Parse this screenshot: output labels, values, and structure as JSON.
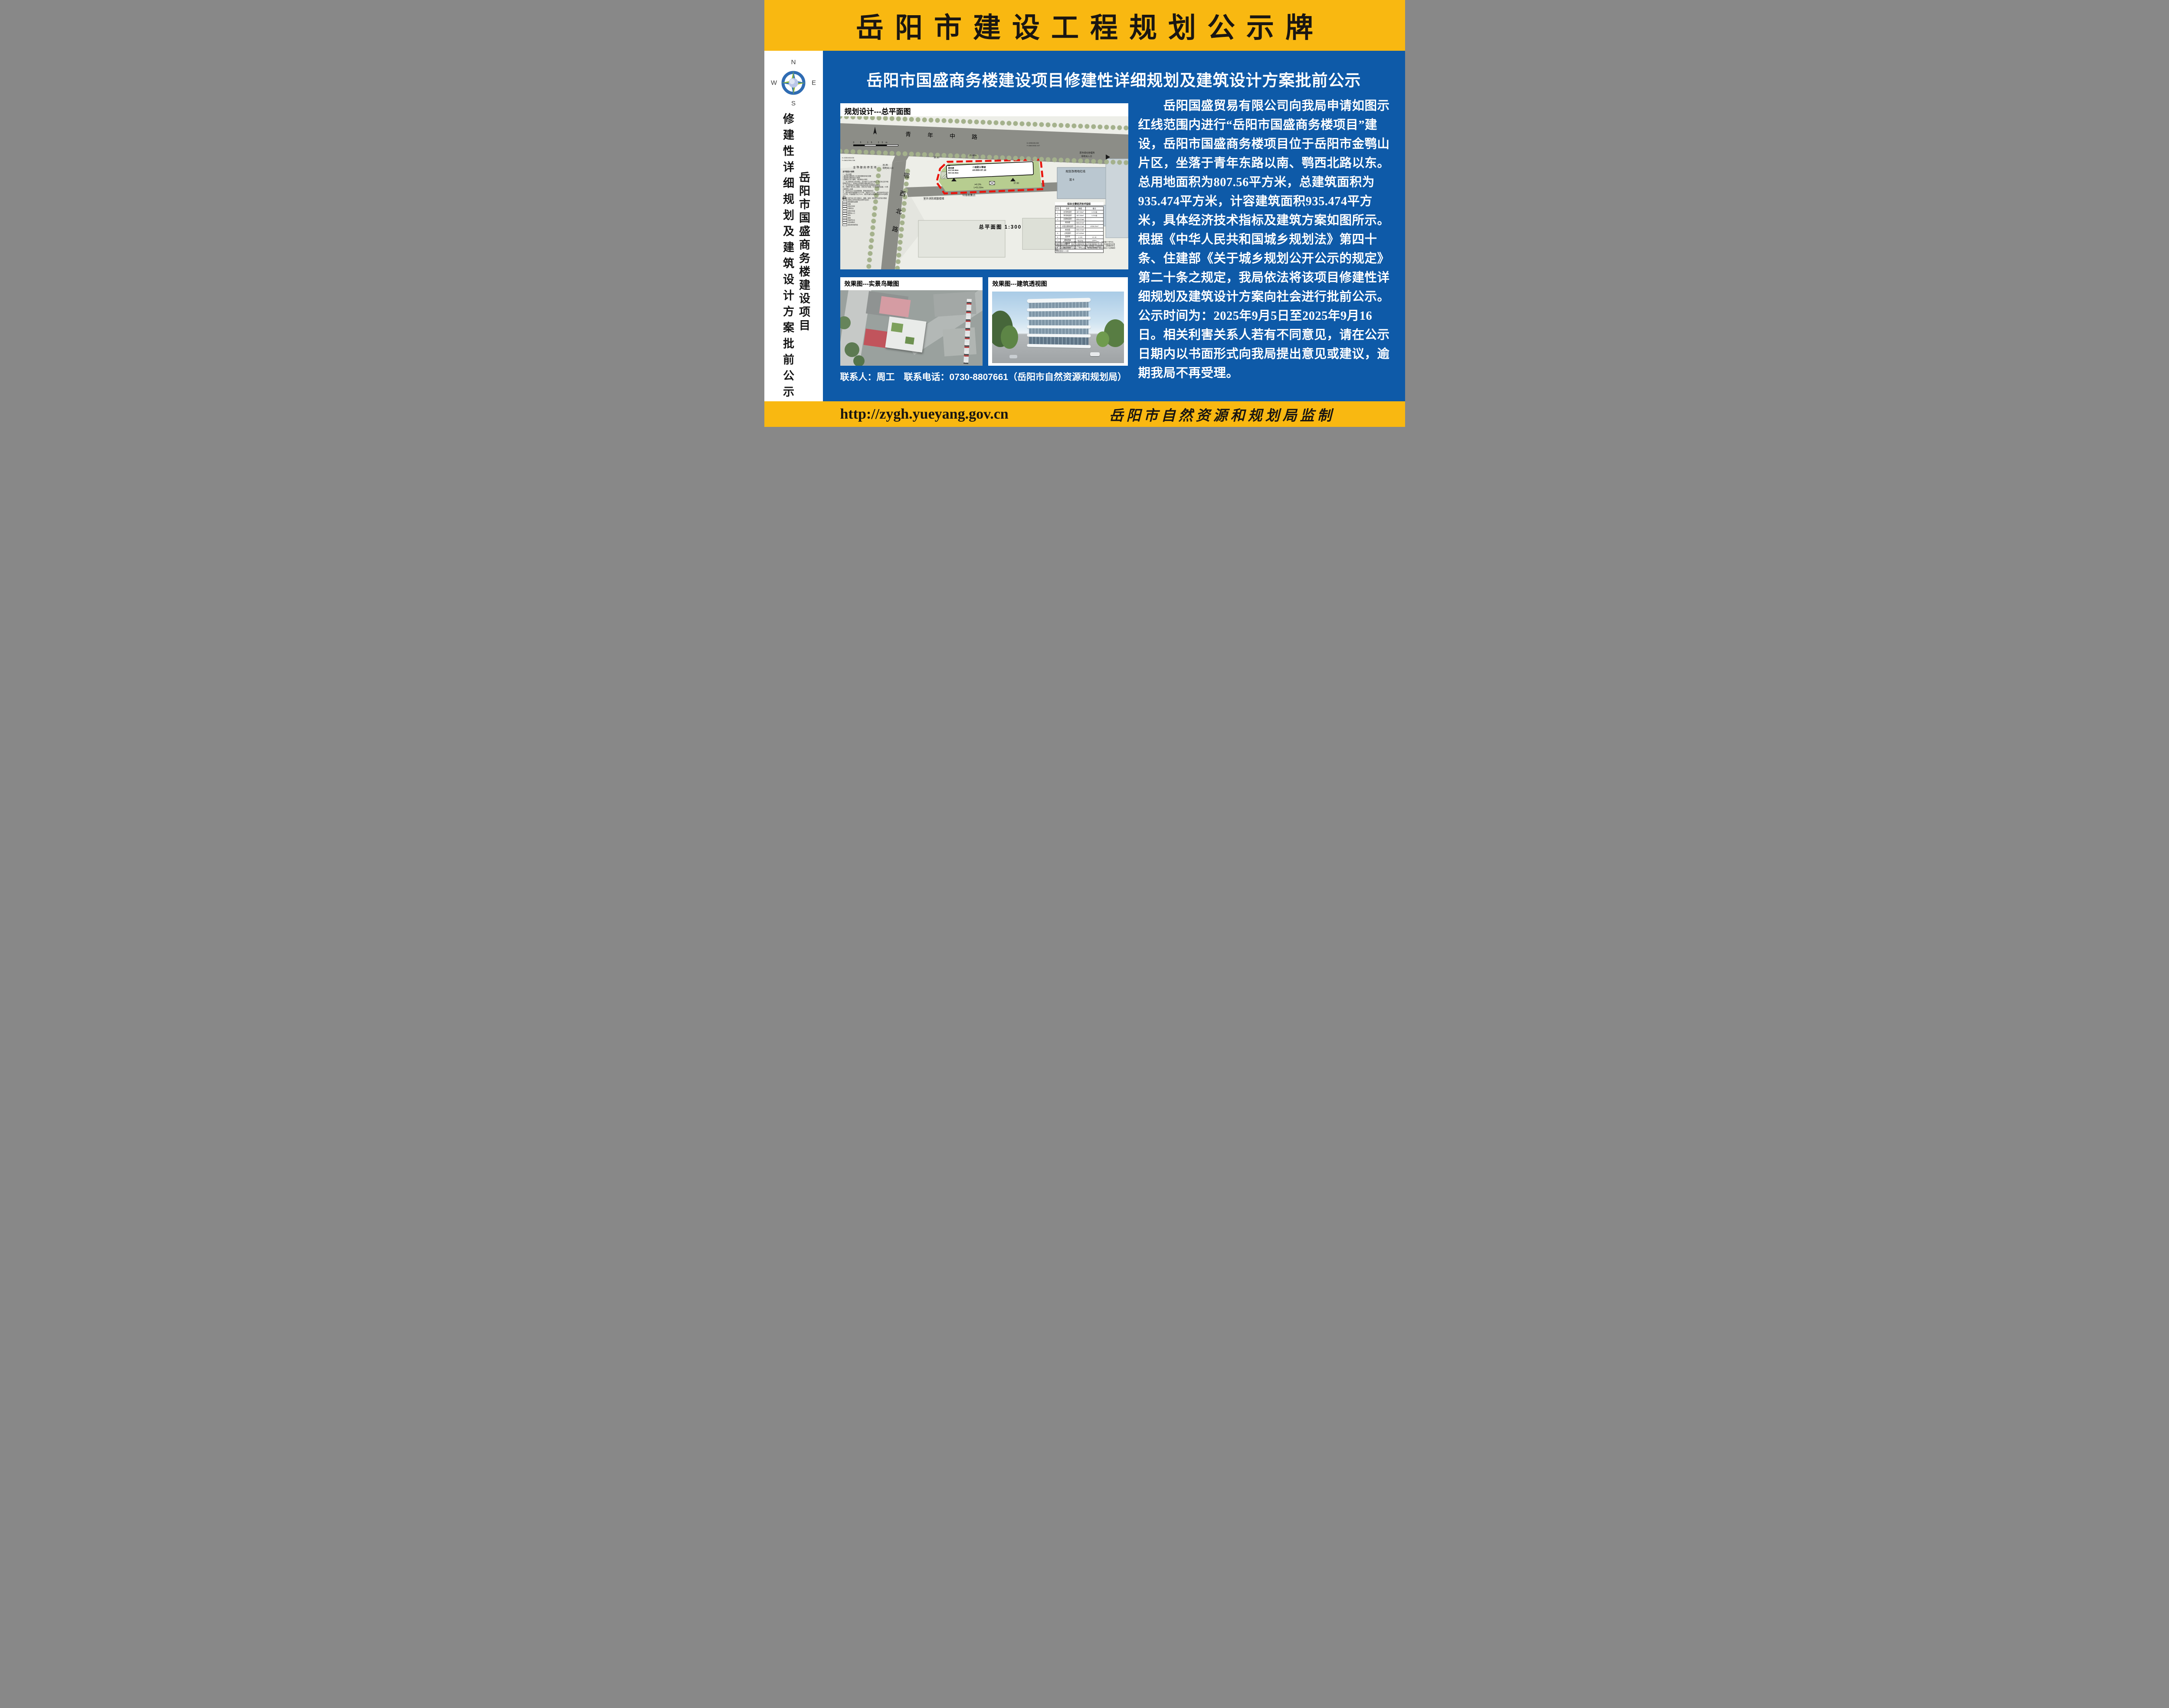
{
  "colors": {
    "yellow": "#F9B811",
    "blue": "#0E5AA8",
    "red": "#E8150C"
  },
  "header": {
    "title": "岳阳市建设工程规划公示牌"
  },
  "sidebar": {
    "compass": {
      "n": "N",
      "s": "S",
      "e": "E",
      "w": "W"
    },
    "vertical_outer": "修建性详细规划及建筑设计方案批前公示",
    "vertical_inner": "岳阳市国盛商务楼建设项目"
  },
  "main": {
    "title": "岳阳市国盛商务楼建设项目修建性详细规划及建筑设计方案批前公示",
    "contact": "联系人：周工　联系电话：0730-8807661（岳阳市自然资源和规划局）",
    "paragraph_lines": [
      "　　岳阳国盛贸易有限公司向我局申请如图示",
      "红线范围内进行“岳阳市国盛商务楼项目”建",
      "设，岳阳市国盛商务楼项目位于岳阳市金鹗山",
      "片区，坐落于青年东路以南、鹗西北路以东。",
      "总用地面积为807.56平方米，总建筑面积为",
      "935.474平方米，计容建筑面积935.474平方",
      "米，具体经济技术指标及建筑方案如图所示。",
      "根据《中华人民共和国城乡规划法》第四十",
      "条、住建部《关于城乡规划公开公示的规定》",
      "第二十条之规定，我局依法将该项目修建性详",
      "细规划及建筑设计方案向社会进行批前公示。",
      "公示时间为：2025年9月5日至2025年9月16",
      "日。相关利害关系人若有不同意见，请在公示",
      "日期内以书面形式向我局提出意见或建议，逾",
      "期我局不再受理。"
    ]
  },
  "site_plan": {
    "label": "规划设计---总平面图",
    "caption": "总平面图 1:300",
    "scale_text": "0 5 15 25m",
    "road_top": "青年中路",
    "road_left": "鄂西北路",
    "building": {
      "lines": [
        "4F",
        "商务楼",
        "H1=16.55m",
        "H2=15.05m"
      ],
      "fire": "二级耐火等级",
      "elev": "±0.000=37.10"
    },
    "labels": {
      "parking_lot": "金鹗御府停车场",
      "entrance_owner": "原市绿化管理所",
      "entrance": "场地出入口",
      "entrance_elev": "36.85",
      "redline": "规划净用地红线",
      "mix6": "混 6",
      "internal_road_1": "接原市绿化管理所",
      "internal_road_2": "内部道路",
      "trash": "垃圾收集点",
      "fire_stairs": "室外消防疏散楼梯",
      "slope": "i=0.3%",
      "road_len": "L=51.50m",
      "spot_37": "37.00",
      "dim_2540": "25.40m",
      "dim_3690": "36.90",
      "coord1_x": "X=3250408.606",
      "coord1_y": "Y=38412994.336",
      "coord2_x": "X=3250406.282",
      "coord2_y": "Y=38413032.107"
    },
    "notes_title": "总平面设计说明",
    "notes_lines": [
      "一、设计依据",
      "1.建设单位提供的1:500地形图和用地红线图",
      "2.建设单位提供的设计要求",
      "3.国家现行关于建筑，消防等设计规范",
      "二、本工程标高以米为单位，总平面尺寸以米为单位，尺寸标注在外墙轮廓的交点上，坐标标注在建筑外墙轮廓的交点上",
      "三、本工程采用2000国家大地坐标系和1985国家高程基准",
      "四、本图中F表示地上层数，D表示地下层数，H1表示建筑高度，H2表示建筑防火高度",
      "五、机动车出入口应设置减速、限速设施及标志",
      "六、图中消防车道宽度不小于4米，净高不小于4米，消防车转弯半径不小于9米，车道坡度不大于10%，消防车道的设置满足消防车50吨荷载要求。",
      "六、本工程不含人防工程设计，道路，景观，园林等专业的设计图纸",
      "七、本工程地上停车位按生态停车位设计"
    ],
    "legend_title": "图例",
    "legend_items": [
      "规划建筑及层数",
      "道路",
      "控制点坐标",
      "间距标注",
      "控制点标高",
      "建筑出入口",
      "绿化",
      "铺地",
      "地面停车位",
      "垃圾收集点",
      "规划净用地界线"
    ],
    "table": {
      "title": "综合主要经济技术指标",
      "headers": [
        "序号",
        "名称",
        "数值",
        "备注"
      ],
      "rows": [
        [
          "1",
          "总用地面积",
          "807.56m²",
          "1.211亩"
        ],
        [
          "2",
          "净用地面积",
          "807.56m²",
          "1.211亩"
        ],
        [
          "3",
          "总建筑面积",
          "935.474m²",
          ""
        ],
        [
          "",
          "商务楼",
          "935.474m²",
          ""
        ],
        [
          "4",
          "计容总建筑面积",
          "935.474m²",
          "≤936.20m²"
        ],
        [
          "",
          "商务楼",
          "935.474m²",
          ""
        ],
        [
          "5",
          "占地面积",
          "227.825m²",
          ""
        ],
        [
          "6",
          "容积率",
          "1.159",
          "≤1.16"
        ],
        [
          "7",
          "建筑密度",
          "28.21%",
          "≤30%"
        ],
        [
          "8",
          "绿地率",
          "24%",
          "≥20%"
        ],
        [
          "9",
          "地面停车位",
          "2个",
          "其中1个充电桩车位"
        ]
      ],
      "footer": "建筑限高21.00米"
    },
    "parking_note": "停车说明：本项目停车泊位根据《国有建设用地使用权出让合同》，应配建5个停车位，因场地受限仅配建2个，剩余不足部分与周边商业配套停车位共享设置；充电桩停车位按《湖南省电动汽车充电设施设计标准》30%配建，应配建1个充电桩车位；无障碍停车位按照《无障碍设计规范》中每100个车位设置1个无障碍停车位，本次共规划1个无障碍停车位。"
  },
  "effects": {
    "aerial_label": "效果图---实景鸟瞰图",
    "perspective_label": "效果图---建筑透视图"
  },
  "footer": {
    "url": "http://zygh.yueyang.gov.cn",
    "producer": "岳阳市自然资源和规划局监制"
  }
}
